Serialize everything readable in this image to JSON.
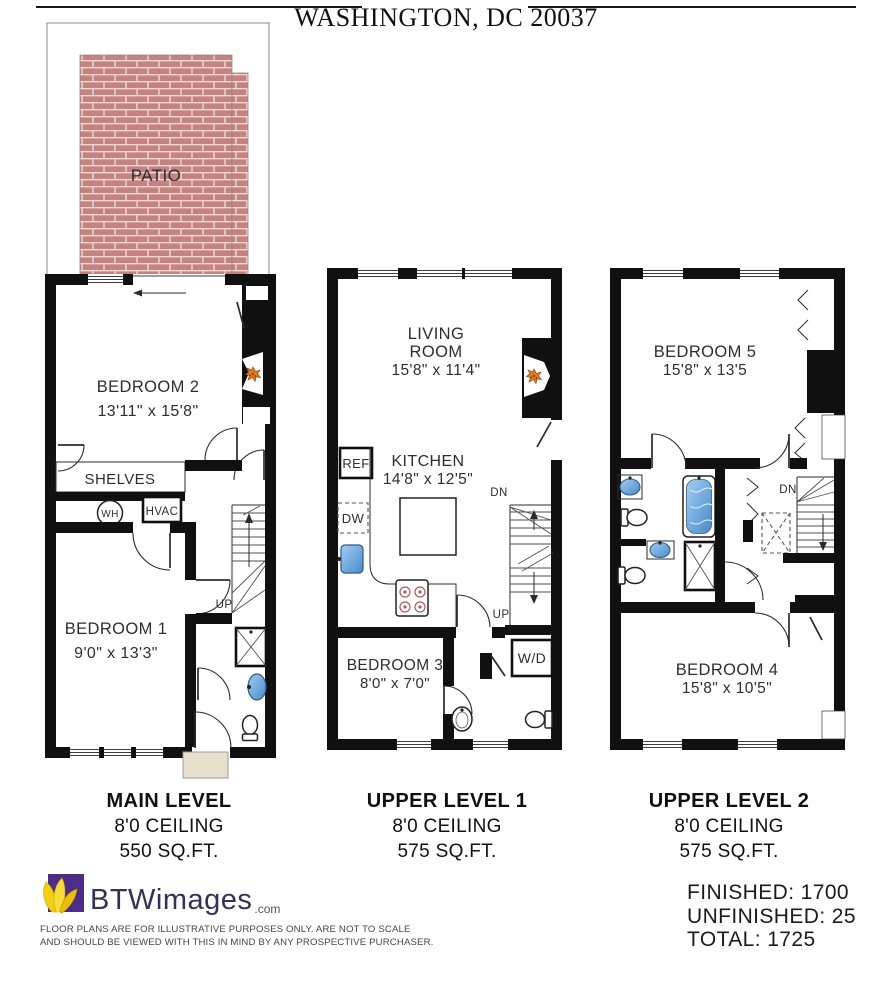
{
  "title": "WASHINGTON, DC 20037",
  "plans": {
    "main": {
      "patio": "PATIO",
      "bedroom2_name": "BEDROOM 2",
      "bedroom2_dims": "13'11\" x 15'8\"",
      "shelves": "SHELVES",
      "wh": "WH",
      "hvac": "HVAC",
      "bedroom1_name": "BEDROOM 1",
      "bedroom1_dims": "9'0\" x 13'3\"",
      "up": "UP",
      "caption_title": "MAIN LEVEL",
      "caption_ceiling": "8'0 CEILING",
      "caption_area": "550  SQ.FT."
    },
    "upper1": {
      "living1": "LIVING",
      "living2": "ROOM",
      "living_dims": "15'8\" x 11'4\"",
      "kitchen_name": "KITCHEN",
      "kitchen_dims": "14'8\" x 12'5\"",
      "ref": "REF",
      "dw": "DW",
      "dn": "DN",
      "up": "UP",
      "wd": "W/D",
      "bedroom3_name": "BEDROOM 3",
      "bedroom3_dims": "8'0\" x 7'0\"",
      "caption_title": "UPPER LEVEL 1",
      "caption_ceiling": "8'0 CEILING",
      "caption_area": "575 SQ.FT."
    },
    "upper2": {
      "bedroom5_name": "BEDROOM 5",
      "bedroom5_dims": "15'8\" x 13'5",
      "dn": "DN",
      "bedroom4_name": "BEDROOM 4",
      "bedroom4_dims": "15'8\" x 10'5\"",
      "caption_title": "UPPER LEVEL 2",
      "caption_ceiling": "8'0 CEILING",
      "caption_area": "575 SQ.FT."
    }
  },
  "footer": {
    "logo": "BTWimages",
    "logo_tld": ".com",
    "disclaimer_line1": "FLOOR PLANS ARE FOR ILLUSTRATIVE PURPOSES ONLY. ARE NOT TO SCALE",
    "disclaimer_line2": "AND SHOULD BE VIEWED WITH THIS IN MIND BY ANY PROSPECTIVE PURCHASER.",
    "finished": "FINISHED: 1700",
    "unfinished": "UNFINISHED: 25",
    "total": "TOTAL: 1725"
  },
  "colors": {
    "brick": "#c5827f",
    "mortar": "#ecdad8",
    "fixture_blue": "#7db5e2",
    "fireplace_orange": "#e0781e",
    "stoop_beige": "#e7e0cd",
    "logo_purple": "#4b2c86",
    "logo_text": "#343156"
  }
}
